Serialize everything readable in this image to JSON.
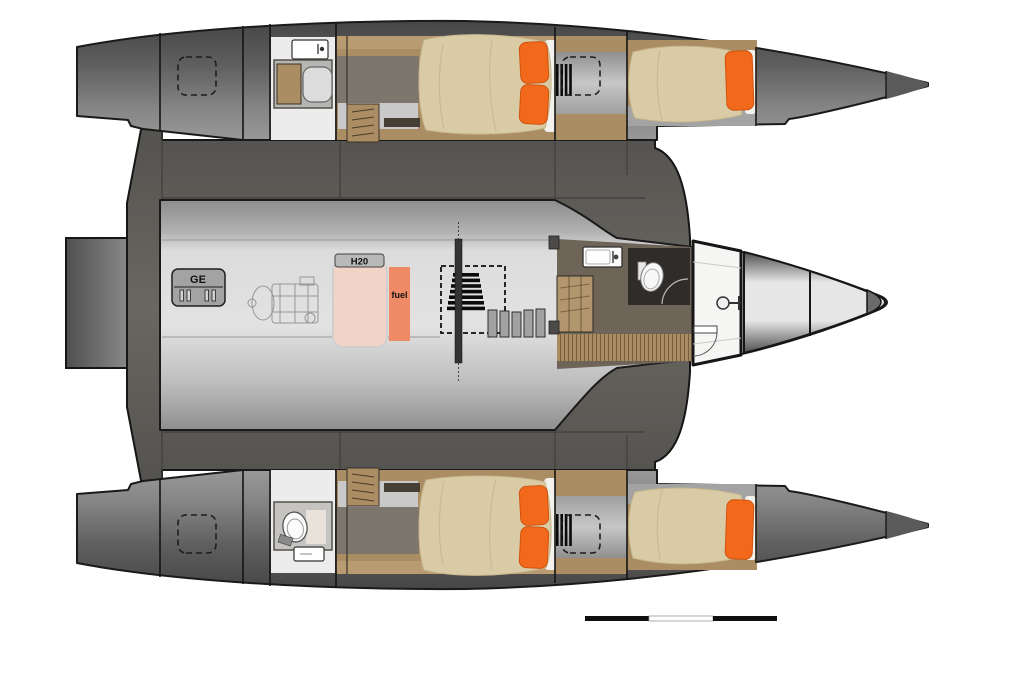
{
  "diagram": {
    "type": "trimaran-yacht-floor-plan",
    "labels": {
      "generator": "GE",
      "water_tank": "H20",
      "fuel_tank": "fuel"
    },
    "colors": {
      "deck": "#5e5c58",
      "wood": "#aa8d62",
      "wood_light": "#b89b71",
      "furniture": "#7c766d",
      "floor": "#6f6458",
      "duvet": "#d9cba5",
      "pillow": "#f2691c",
      "water_tank": "#f2d3c8",
      "fuel_tank": "#ef8a66",
      "bathroom": "#ececec",
      "toilet_room": "#2f2c29",
      "scale_bar": "#0f0f0f",
      "background": "#ffffff"
    },
    "scale_bar": {
      "segments": [
        "black",
        "white",
        "black"
      ]
    }
  }
}
